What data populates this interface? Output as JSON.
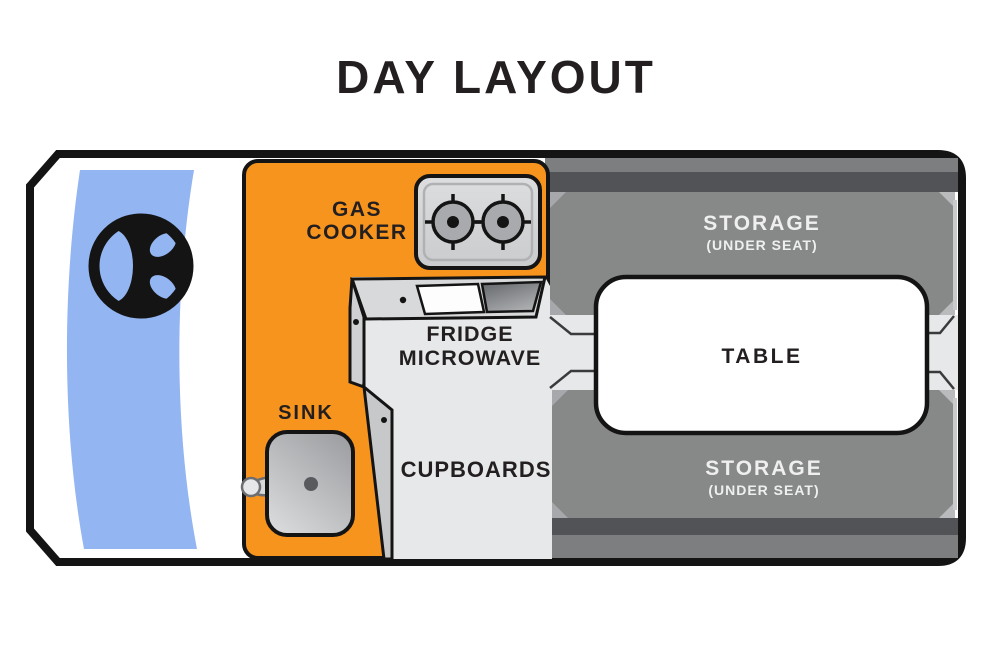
{
  "title": "DAY LAYOUT",
  "colors": {
    "orange": "#F7941E",
    "windshield_blue": "#93B5F2",
    "storage_gray": "#878989",
    "dark_band": "#525356",
    "strip_gray": "#7C7E80",
    "light_floor": "#E7E8E9",
    "counter_panel": "#D8D9DA",
    "facet_gray": "#C7C8CA",
    "cooker_body": "#D3D4D6",
    "burner_gray": "#A8AAAD",
    "outline": "#1A1A1A",
    "text_dark": "#231F20",
    "text_light": "#EFEFF0"
  },
  "icons": {
    "steering_wheel": "steering-wheel-icon",
    "burner": "stove-burner-icon",
    "faucet": "faucet-icon"
  },
  "areas": {
    "gas_cooker": {
      "line1": "GAS",
      "line2": "COOKER"
    },
    "fridge_microwave": {
      "line1": "FRIDGE",
      "line2": "MICROWAVE"
    },
    "sink": {
      "label": "SINK"
    },
    "cupboards": {
      "label": "CUPBOARDS"
    },
    "table": {
      "label": "TABLE"
    },
    "storage_top": {
      "label": "STORAGE",
      "sublabel": "(UNDER SEAT)"
    },
    "storage_bottom": {
      "label": "STORAGE",
      "sublabel": "(UNDER SEAT)"
    }
  }
}
